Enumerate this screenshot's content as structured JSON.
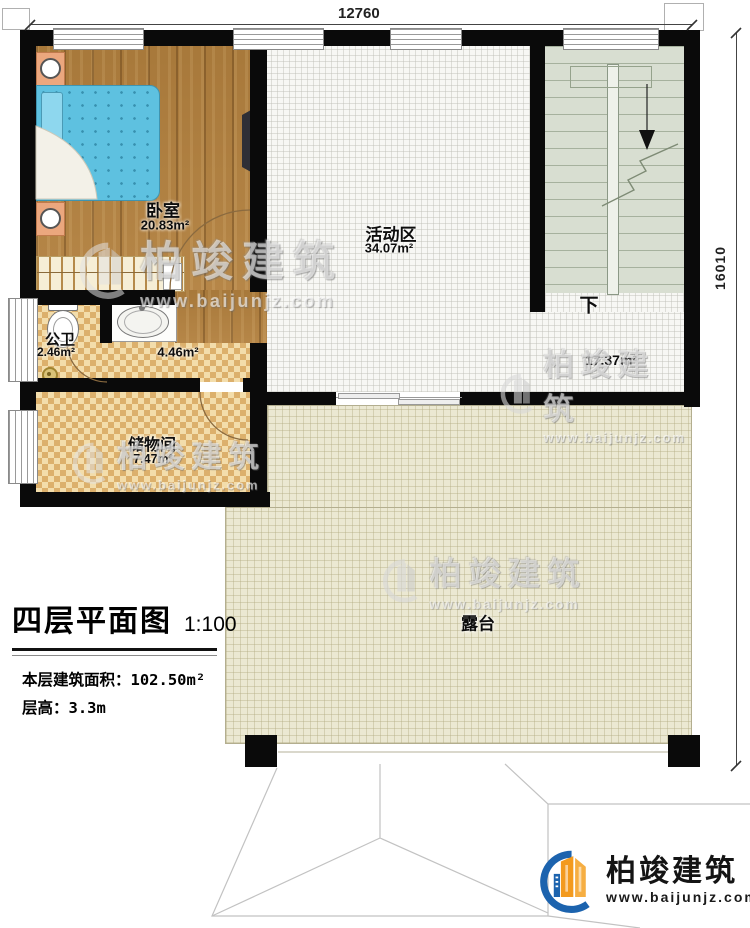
{
  "brand": {
    "name": "柏竣建筑",
    "url": "www.baijunjz.com"
  },
  "dimensions": {
    "top": "12760",
    "right": "16010"
  },
  "rooms": {
    "bedroom": {
      "label": "卧室",
      "area": "20.83m²"
    },
    "activity": {
      "label": "活动区",
      "area": "34.07m²"
    },
    "bath": {
      "label": "公卫",
      "area": "2.46m²"
    },
    "wash": {
      "area": "4.46m²"
    },
    "storage": {
      "label": "储物间",
      "area": "7.47m²"
    },
    "hall": {
      "area": "17.37m²"
    },
    "terrace": {
      "label": "露台"
    },
    "stairs": {
      "down_label": "下"
    }
  },
  "title_block": {
    "title": "四层平面图",
    "scale": "1:100",
    "area_label": "本层建筑面积：",
    "area_value": "102.50m²",
    "height_label": "层高：",
    "height_value": "3.3m"
  },
  "colors": {
    "wall": "#0a0a0a",
    "wood_floor": "#b2803e",
    "tile_light": "#f3ddab",
    "tile_dark": "#dcb06c",
    "terrace": "#ebe8d2",
    "stairs": "#d8ded1",
    "bed": "#5ec1e0",
    "logo_blue": "#1c63ae",
    "logo_orange": "#f39a1e"
  }
}
